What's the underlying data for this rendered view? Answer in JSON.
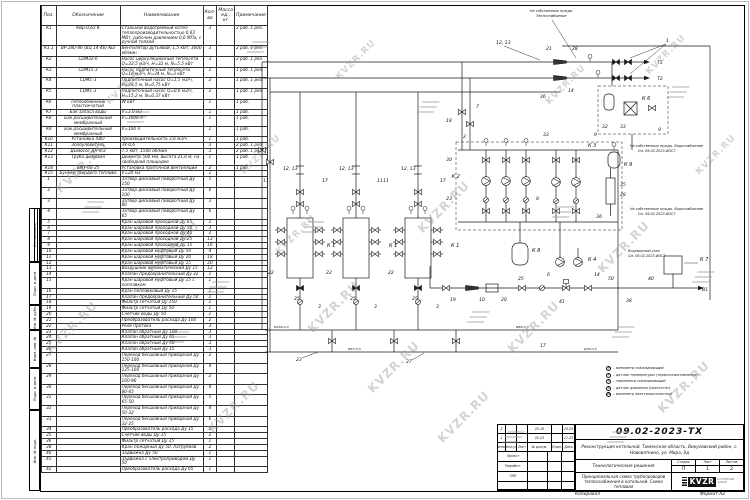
{
  "watermark": {
    "text": "KVZR.RU"
  },
  "side_strip": {
    "boxes": [
      "Согласовано",
      "Подп. и дата",
      "Инв. № дубл.",
      "Взам. инв. №",
      "Подп. и дата",
      "Инв. № подл."
    ]
  },
  "spec_table": {
    "headers": {
      "pos": "Поз.",
      "des": "Обозначение",
      "name": "Наименование",
      "qty": "Кол-во",
      "mass": "Масса ед., кг",
      "note": "Примечание"
    },
    "rows": [
      {
        "pos": "К1",
        "des": "КВр-0,63 К",
        "name": "Стальной водогрейный котел теплопроизводительностью 0,63 МВт, рабочим давлением 0,6 МПа, с ручной топкой",
        "qty": "3",
        "mass": "",
        "note": "2 раб. 1 рез."
      },
      {
        "pos": "К1.1",
        "des": "ВР-280-46 (ВЦ 14-46) №2",
        "name": "Вентилятор дутьевой, 1,5 кВт, 3000 об/мин",
        "qty": "3",
        "mass": "",
        "note": "2 раб. 1 рез."
      },
      {
        "pos": "К2",
        "des": "CDM32-6",
        "name": "Насос циркуляционный теплосети Q=32,5 м3/ч, Н=32 м, N=5,5 кВт",
        "qty": "3",
        "mass": "",
        "note": "2 раб. 1 рез."
      },
      {
        "pos": "К3",
        "des": "CDM15-3",
        "name": "Насос подпиточный теплосети Q=16 м3/ч, Н=34 м, N=3 кВт",
        "qty": "2",
        "mass": "",
        "note": "1 раб. 1 рез."
      },
      {
        "pos": "К4",
        "des": "CDM1-3",
        "name": "Подпиточный насос Q=1,5 м3/ч, Н=28,5 м, N=0,75 кВт",
        "qty": "2",
        "mass": "",
        "note": "1 раб. 1 рез."
      },
      {
        "pos": "К5",
        "des": "CDM1-3",
        "name": "Подпиточный насос Q=0,6 м3/ч, Н=15,2 м, N=0,37 кВт",
        "qty": "2",
        "mass": "",
        "note": "1 раб. 1 рез."
      },
      {
        "pos": "К6",
        "des": "Теплообменник пластинчатый",
        "name": "W кВт",
        "qty": "1",
        "mass": "",
        "note": "1 раб."
      },
      {
        "pos": "К7",
        "des": "Бак запаса воды",
        "name": "V=3,0 м3",
        "qty": "1",
        "mass": "",
        "note": "1 раб."
      },
      {
        "pos": "К8",
        "des": "Бак расширительный мембранный",
        "name": "V=1000 л",
        "qty": "1",
        "mass": "",
        "note": "1 раб."
      },
      {
        "pos": "К9",
        "des": "Бак расширительный мембранный",
        "name": "V=100 л",
        "qty": "1",
        "mass": "",
        "note": "1 раб."
      },
      {
        "pos": "К10",
        "des": "Установка ХВО",
        "name": "производительность 3,6 м3/ч",
        "qty": "1",
        "mass": "",
        "note": "1 раб."
      },
      {
        "pos": "К11",
        "des": "Золоуловитель",
        "name": "ЗУ-0,6",
        "qty": "3",
        "mass": "",
        "note": "2 раб. 1 рез."
      },
      {
        "pos": "К12",
        "des": "Дымосос ДН-6,3",
        "name": "7,5 кВт, 1500 об/мин",
        "qty": "3",
        "mass": "",
        "note": "2 раб. 1 рез."
      },
      {
        "pos": "К13",
        "des": "Труба дымовая",
        "name": "Диаметр 500 мм, высота 21,0 м, на свободной площадке",
        "qty": "1",
        "mass": "",
        "note": "1 раб."
      },
      {
        "pos": "К14",
        "des": "ВМУ-60-25",
        "name": "Установка приточной вентиляции",
        "qty": "2",
        "mass": "",
        "note": "1 раб."
      },
      {
        "pos": "К15",
        "des": "Бункер твердого топлива",
        "name": "V=20 м3",
        "qty": "1",
        "mass": "",
        "note": ""
      },
      {
        "pos": "1",
        "des": "",
        "name": "Затвор дисковый поворотный Ду 150",
        "qty": "5",
        "mass": "",
        "note": ""
      },
      {
        "pos": "2",
        "des": "",
        "name": "Затвор дисковый поворотный Ду 100",
        "qty": "6",
        "mass": "",
        "note": ""
      },
      {
        "pos": "3",
        "des": "",
        "name": "Затвор дисковый поворотный Ду 80",
        "qty": "3",
        "mass": "",
        "note": ""
      },
      {
        "pos": "4",
        "des": "",
        "name": "Затвор дисковый поворотный Ду 65",
        "qty": "6",
        "mass": "",
        "note": ""
      },
      {
        "pos": "5",
        "des": "",
        "name": "Кран шаровой проходной Ду 65",
        "qty": "2",
        "mass": "",
        "note": ""
      },
      {
        "pos": "6",
        "des": "",
        "name": "Кран шаровой проходной Ду 50",
        "qty": "3",
        "mass": "",
        "note": ""
      },
      {
        "pos": "7",
        "des": "",
        "name": "Кран шаровой проходной Ду 40",
        "qty": "2",
        "mass": "",
        "note": ""
      },
      {
        "pos": "8",
        "des": "",
        "name": "Кран шаровой проходной Ду 25",
        "qty": "13",
        "mass": "",
        "note": ""
      },
      {
        "pos": "9",
        "des": "",
        "name": "Кран шаровой проходной Ду 15",
        "qty": "16",
        "mass": "",
        "note": ""
      },
      {
        "pos": "10",
        "des": "",
        "name": "Кран шаровой муфтовый Ду 50",
        "qty": "4",
        "mass": "",
        "note": ""
      },
      {
        "pos": "11",
        "des": "",
        "name": "Кран шаровой муфтовый Ду 20",
        "qty": "18",
        "mass": "",
        "note": ""
      },
      {
        "pos": "12",
        "des": "",
        "name": "Кран шаровой муфтовый Ду 15",
        "qty": "20",
        "mass": "",
        "note": ""
      },
      {
        "pos": "13",
        "des": "",
        "name": "Воздушник автоматический Ду 15",
        "qty": "12",
        "mass": "",
        "note": ""
      },
      {
        "pos": "14",
        "des": "",
        "name": "Клапан предохранительный Ду 32",
        "qty": "1",
        "mass": "",
        "note": ""
      },
      {
        "pos": "15",
        "des": "",
        "name": "Кран шаровой муфтовый Ду 15 с поплавком",
        "qty": "1",
        "mass": "",
        "note": ""
      },
      {
        "pos": "16",
        "des": "",
        "name": "Кран поплавковый Ду 15",
        "qty": "1",
        "mass": "",
        "note": ""
      },
      {
        "pos": "17",
        "des": "",
        "name": "Клапан предохранительный Ду 50",
        "qty": "2",
        "mass": "",
        "note": ""
      },
      {
        "pos": "18",
        "des": "",
        "name": "Фильтр сетчатый Ду 150",
        "qty": "1",
        "mass": "",
        "note": ""
      },
      {
        "pos": "19",
        "des": "",
        "name": "Фильтр сетчатый Ду 50",
        "qty": "1",
        "mass": "",
        "note": ""
      },
      {
        "pos": "20",
        "des": "",
        "name": "Счетчик воды Ду 50",
        "qty": "1",
        "mass": "",
        "note": ""
      },
      {
        "pos": "21",
        "des": "",
        "name": "Преобразователь расхода Ду 100",
        "qty": "2",
        "mass": "",
        "note": ""
      },
      {
        "pos": "22",
        "des": "",
        "name": "Реле протока",
        "qty": "3",
        "mass": "",
        "note": ""
      },
      {
        "pos": "23",
        "des": "",
        "name": "Клапан обратный Ду 100",
        "qty": "3",
        "mass": "",
        "note": ""
      },
      {
        "pos": "24",
        "des": "",
        "name": "Клапан обратный Ду 65",
        "qty": "3",
        "mass": "",
        "note": ""
      },
      {
        "pos": "25",
        "des": "",
        "name": "Клапан обратный Ду 50",
        "qty": "3",
        "mass": "",
        "note": ""
      },
      {
        "pos": "26",
        "des": "",
        "name": "Клапан обратный Ду 15",
        "qty": "3",
        "mass": "",
        "note": ""
      },
      {
        "pos": "27",
        "des": "",
        "name": "Переход бесшовный приварной Ду 150-100",
        "qty": "2",
        "mass": "",
        "note": ""
      },
      {
        "pos": "28",
        "des": "",
        "name": "Переход бесшовный приварной Ду 125-100",
        "qty": "4",
        "mass": "",
        "note": ""
      },
      {
        "pos": "29",
        "des": "",
        "name": "Переход бесшовный приварной Ду 100-80",
        "qty": "2",
        "mass": "",
        "note": ""
      },
      {
        "pos": "30",
        "des": "",
        "name": "Переход бесшовный приварной Ду 80-65",
        "qty": "4",
        "mass": "",
        "note": ""
      },
      {
        "pos": "31",
        "des": "",
        "name": "Переход бесшовный приварной Ду 65-50",
        "qty": "5",
        "mass": "",
        "note": ""
      },
      {
        "pos": "32",
        "des": "",
        "name": "Переход бесшовный приварной Ду 50-32",
        "qty": "4",
        "mass": "",
        "note": ""
      },
      {
        "pos": "33",
        "des": "",
        "name": "Переход бесшовный приварной Ду 32-25",
        "qty": "6",
        "mass": "",
        "note": ""
      },
      {
        "pos": "34",
        "des": "",
        "name": "Преобразователь расхода Ду 15",
        "qty": "2",
        "mass": "",
        "note": ""
      },
      {
        "pos": "35",
        "des": "",
        "name": "Счетчик воды Ду 15",
        "qty": "2",
        "mass": "",
        "note": ""
      },
      {
        "pos": "36",
        "des": "",
        "name": "Фильтр сетчатый Ду 15",
        "qty": "1",
        "mass": "",
        "note": ""
      },
      {
        "pos": "38",
        "des": "",
        "name": "Кран пожарный Ду 50, патрубков",
        "qty": "2",
        "mass": "",
        "note": ""
      },
      {
        "pos": "40",
        "des": "",
        "name": "Задвижка Ду 50",
        "qty": "1",
        "mass": "",
        "note": ""
      },
      {
        "pos": "41",
        "des": "",
        "name": "Задвижка с электроприводом Ду 50",
        "qty": "1",
        "mass": "",
        "note": ""
      },
      {
        "pos": "42",
        "des": "",
        "name": "Преобразователь расхода Ду 65",
        "qty": "1",
        "mass": "",
        "note": ""
      }
    ]
  },
  "diagram": {
    "flows": {
      "t1": "Т1",
      "t2": "Т2",
      "v1": "В1"
    },
    "equipment": {
      "k1": "К 1",
      "k2": "К 2",
      "k3": "К 3",
      "k4": "К 4",
      "k6": "К 6",
      "k7": "К 7",
      "k8": "К 8",
      "k9": "К 9"
    },
    "callouts": {
      "c1": "1",
      "c2": "2",
      "c3": "3",
      "c6": "6",
      "c7": "7",
      "c8": "8",
      "c9": "9",
      "c10": "10",
      "c11": "11",
      "c12_13": "12, 13",
      "c14": "14",
      "c17": "17",
      "c18": "18",
      "c19": "19",
      "c20": "20",
      "c21": "21",
      "c22": "22",
      "c23": "23",
      "c25": "25",
      "c27": "27",
      "c28": "28",
      "c30": "30",
      "c32": "32",
      "c33": "33",
      "c35": "35",
      "c36": "36",
      "c38": "38",
      "c40": "40",
      "c41": "41",
      "c50": "50"
    },
    "pipes": {
      "p108": "Ø108х4,0",
      "p89": "Ø89х3,5",
      "p76": "Ø76х3,5",
      "p57": "Ø57х3,5"
    },
    "notes": {
      "own_heat_1": "На собственные нужды.",
      "own_heat_2": "Теплоснабжение",
      "own_water_1": "На собственные нужды. Водоснабжение",
      "own_water_2": "См. 09.02-2023-ИОС7",
      "node_1": "Водомерный узел",
      "node_2": "См. 09.02-2023-ИОС7"
    },
    "legend": [
      {
        "sym": "P",
        "label": "– манометр показывающий"
      },
      {
        "sym": "T",
        "label": "– датчик температуры (термосопротивление)"
      },
      {
        "sym": "t",
        "label": "– термометр показывающий"
      },
      {
        "sym": "P",
        "label": "– датчик давления (пресостат)"
      },
      {
        "sym": "PE",
        "label": "– манометр электроконтактный"
      }
    ]
  },
  "title_block": {
    "doc_number": "09.02-2023-ТХ",
    "object": "Реконструкция котельной. Тюменская область, Викуловский район, с. Нововяткино, ул. Мира, 9д",
    "section": "Технологические решения",
    "stage_label": "Стадия",
    "sheet_label": "Лист",
    "sheets_label": "Листов",
    "stage": "П",
    "sheet": "1",
    "sheets": "2",
    "sheet_title": "Принципиальная схема трубопроводов теплоснабжения в котельной. Схема тепловая",
    "logo": "KVZR",
    "logo_sub": "КОТЕЛЬНЫЙ ЗАВОД",
    "rev_header": {
      "izm": "Изм.",
      "koluch": "Кол.уч.",
      "list": "Лист",
      "dokum": "№ докум.",
      "podp": "Подп.",
      "data": "Дата"
    },
    "revisions": [
      {
        "izm": "2",
        "koluch": "",
        "list": "",
        "dokum": "25-19",
        "podp": "",
        "data": "10.24"
      },
      {
        "izm": "1",
        "koluch": "",
        "list": "",
        "dokum": "25-23",
        "podp": "",
        "data": "11.23"
      }
    ],
    "roles": [
      {
        "label": "Проект"
      },
      {
        "label": "Разработ."
      },
      {
        "label": "ГИП"
      }
    ]
  },
  "footer": {
    "copied": "Копировал",
    "format": "Формат А2"
  }
}
